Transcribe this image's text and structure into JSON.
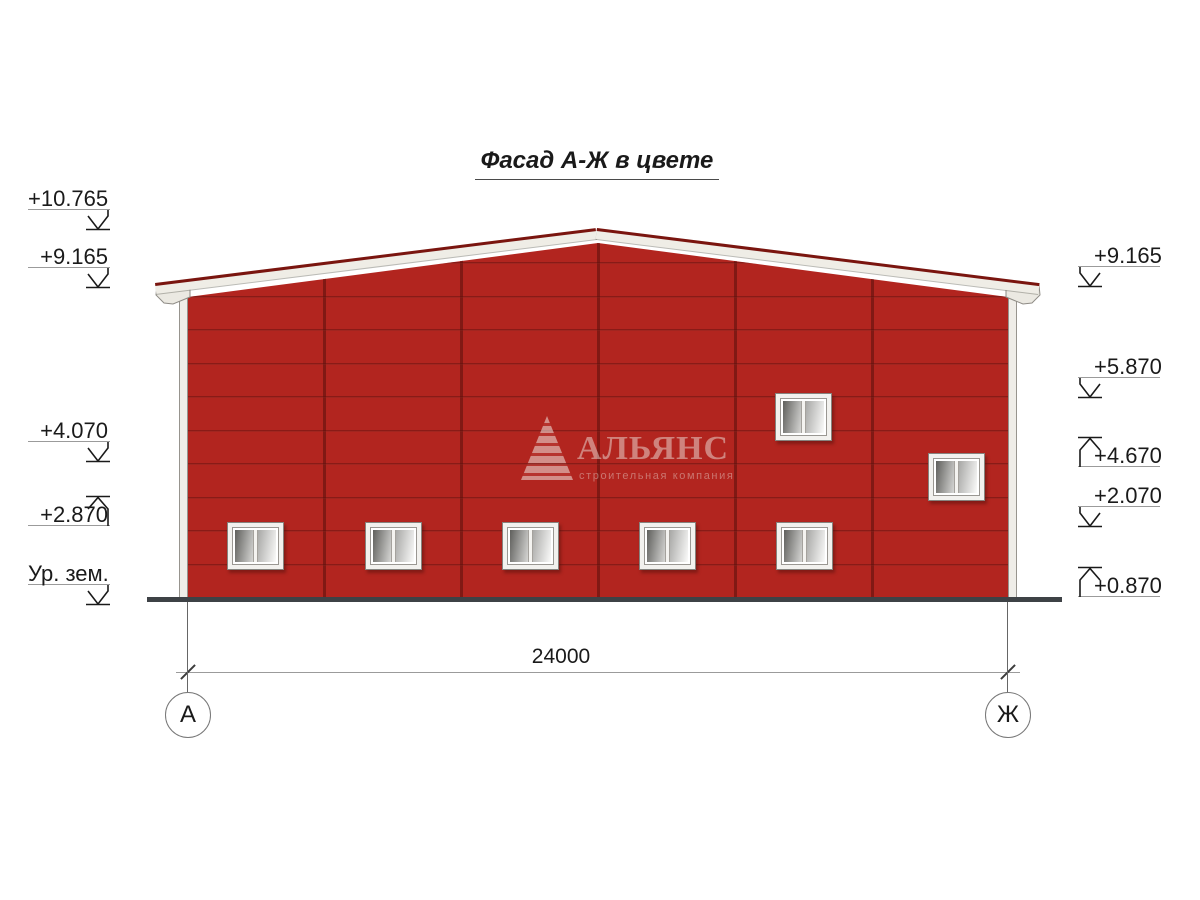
{
  "title": "Фасад А-Ж в цвете",
  "dimension_label": "24000",
  "axes": {
    "left": "А",
    "right": "Ж"
  },
  "elevations": {
    "left": [
      {
        "label": "+10.765",
        "arrow": "down"
      },
      {
        "label": "+9.165",
        "arrow": "down"
      },
      {
        "label": "+4.070",
        "arrow": "down"
      },
      {
        "label": "+2.870",
        "arrow": "up"
      },
      {
        "label": "Ур. зем.",
        "arrow": "down"
      }
    ],
    "right": [
      {
        "label": "+9.165",
        "arrow": "down"
      },
      {
        "label": "+5.870",
        "arrow": "down"
      },
      {
        "label": "+4.670",
        "arrow": "up"
      },
      {
        "label": "+2.070",
        "arrow": "down"
      },
      {
        "label": "+0.870",
        "arrow": "up"
      }
    ]
  },
  "watermark": {
    "brand": "АЛЬЯНС",
    "tagline": "строительная компания"
  },
  "building": {
    "bays": 6,
    "windows_lower_row": 5,
    "windows_upper": 2
  },
  "colors": {
    "facade_red": "#B2251F",
    "panel_joint": "#771813",
    "roof_edge_red": "#7A150F",
    "fascia_white": "#EFEDE6",
    "ground_line": "#3E4246"
  }
}
